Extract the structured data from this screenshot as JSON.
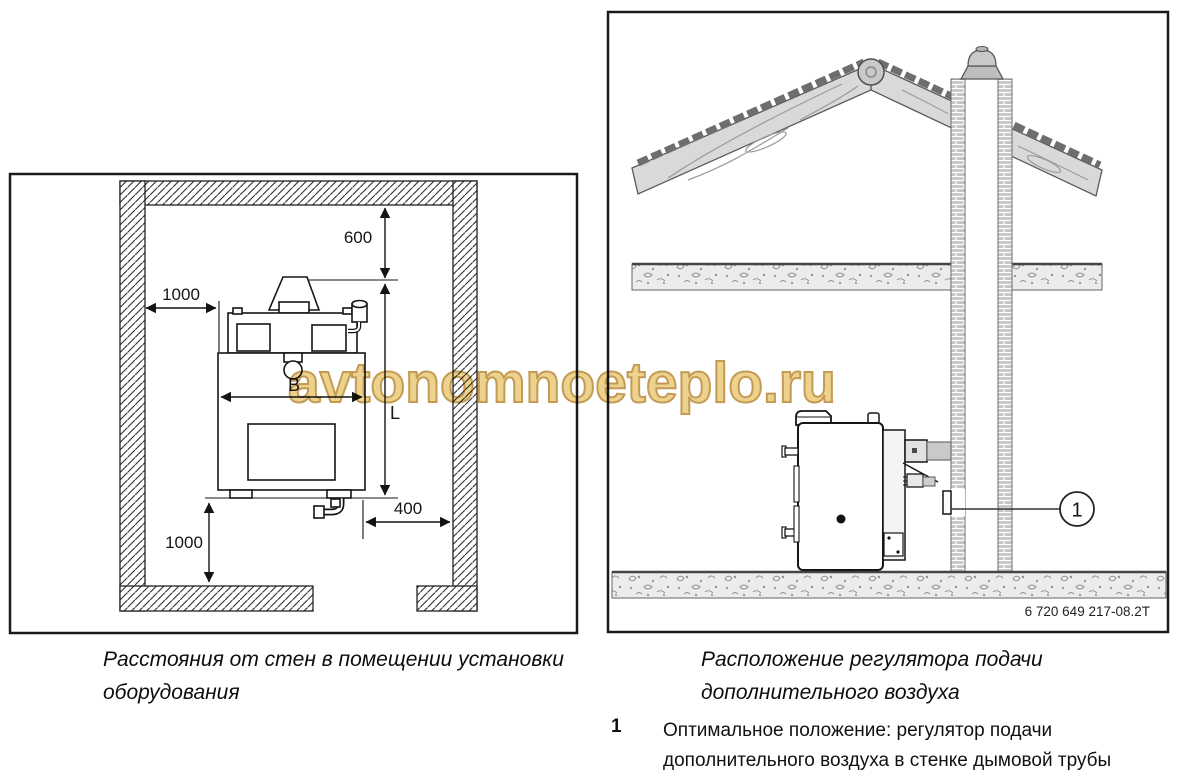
{
  "watermark": {
    "text": "avtonomnoeteplo.ru",
    "fill_color": "#ecd28d",
    "outline_color": "#c49b55"
  },
  "left_figure": {
    "caption_line1": "Расстояния от стен в помещении установки",
    "caption_line2": "оборудования",
    "dimensions": {
      "top_clearance": "600",
      "left_clearance": "1000",
      "boiler_width": "B",
      "boiler_length": "L",
      "right_clearance": "400",
      "bottom_clearance": "1000"
    }
  },
  "right_figure": {
    "caption_line1": "Расположение регулятора подачи",
    "caption_line2": "дополнительного воздуха",
    "callout_number": "1",
    "drawing_code": "6 720 649 217-08.2T"
  },
  "legend": {
    "item_number": "1",
    "item_text_line1": "Оптимальное положение: регулятор подачи",
    "item_text_line2": "дополнительного воздуха в стенке дымовой трубы"
  }
}
